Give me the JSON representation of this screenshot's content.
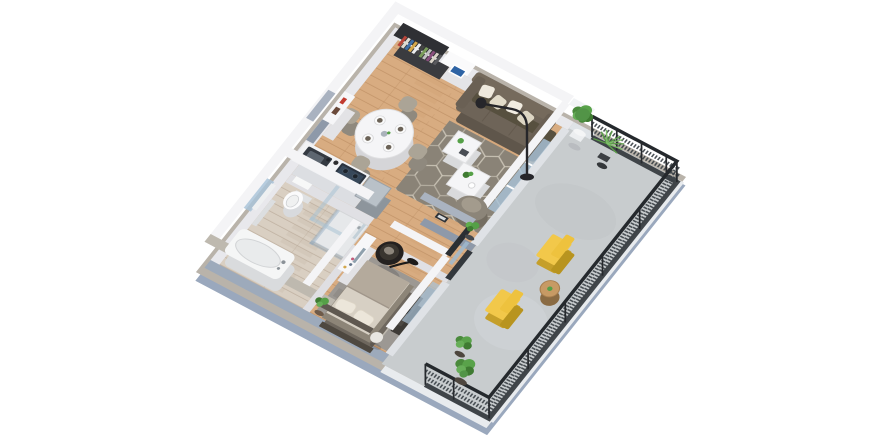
{
  "page": {
    "type": "3d-isometric-floor-plan-render",
    "background": "#ffffff",
    "visible_text": "none"
  },
  "palette": {
    "bg": "#ffffff",
    "wood": "#d8ac81",
    "bathfloor": "#d9cfc2",
    "concrete": "#c8ccce",
    "ruglive": "#8a8377",
    "rugbed": "#9c9893",
    "walltop": "#f4f4f6",
    "wallside": "#e8e8ec",
    "slabside": "#9aa8bd",
    "slabrim": "#b9b3aa",
    "sofa": "#6e6458",
    "sofadark": "#5f564b",
    "cushion": "#efe9dd",
    "yellow": "#f2c84a",
    "yellowdark": "#c59f2a",
    "plant": "#55a047",
    "plantdark": "#3f7b32",
    "railing": "#33383d",
    "countertop": "#2b3440",
    "glass": "#a9c3d8",
    "white_furn": "#f5f5f7",
    "mattress": "#d7d0c4",
    "blanket": "#b4aa9c",
    "graywall": "#8e99a9"
  },
  "scene": {
    "view": "isometric-birds-eye",
    "rooms": [
      {
        "name": "living-dining-room",
        "floor": "light-oak-plank",
        "furniture": [
          "bookshelf-with-books",
          "white-cabinet-with-picture",
          "three-seat-sofa-with-pillows",
          "hexagon-pattern-rug",
          "two-white-coffee-tables",
          "curved-armchair",
          "arc-floor-lamp",
          "round-dining-table-set-for-four",
          "four-dining-chairs",
          "white-sideboard"
        ]
      },
      {
        "name": "kitchen",
        "floor": "light-oak-plank",
        "furniture": [
          "counter-with-dark-top",
          "inset-sink",
          "glossy-cooktop",
          "stainless-appliance-unit"
        ]
      },
      {
        "name": "bathroom",
        "floor": "pale-washed-wood",
        "furniture": [
          "toilet",
          "glass-walk-in-shower",
          "bathtub",
          "wall-radiator",
          "frosted-window"
        ]
      },
      {
        "name": "bedroom",
        "floor": "light-oak-plank",
        "furniture": [
          "double-bed-with-headboard",
          "gray-area-rug",
          "black-hanging-bowl-chair",
          "vanity-with-mirror",
          "dark-media-bench",
          "white-ball-ottoman",
          "potted-plant"
        ]
      },
      {
        "name": "balcony-terrace",
        "floor": "concrete",
        "furniture": [
          "two-yellow-sling-loungers",
          "round-wood-side-table",
          "fiddle-leaf-plant",
          "spiky-palm-plant",
          "two-leafy-bushes",
          "black-mesh-railing",
          "white-parapet"
        ]
      }
    ],
    "counts": {
      "dining_chairs": 4,
      "coffee_tables": 2,
      "yellow_loungers": 2,
      "balcony_plants": 4,
      "sofa_pillows": 4
    }
  }
}
